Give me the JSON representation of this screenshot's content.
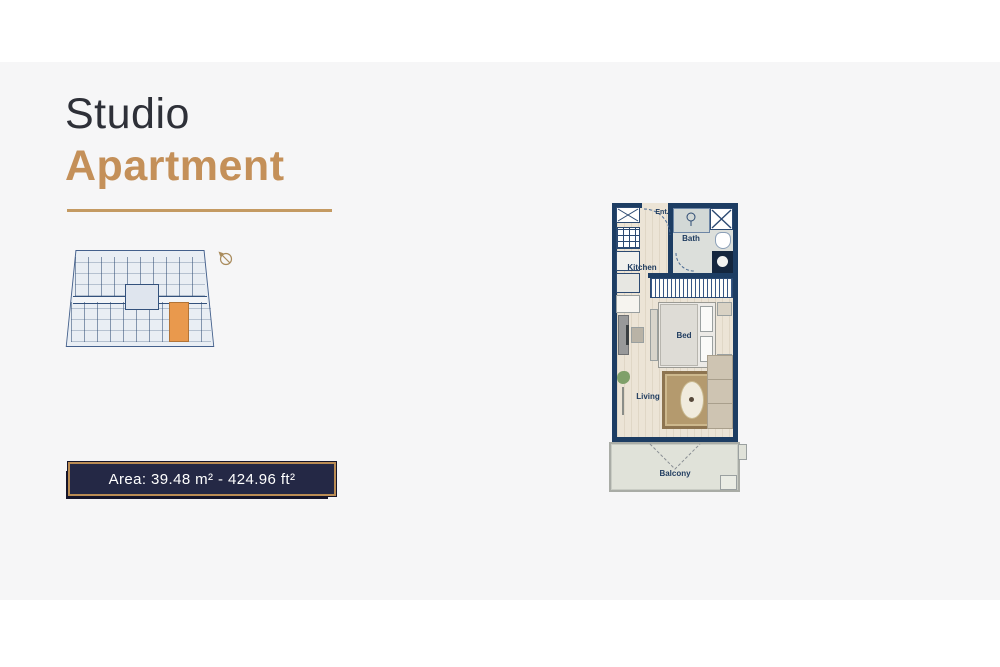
{
  "page": {
    "background": "#ffffff",
    "band_color": "#f6f6f7"
  },
  "header": {
    "title_line1": "Studio",
    "title_line2": "Apartment",
    "title_color": "#2e3038",
    "accent_color": "#c49059",
    "underline_color": "#c49a62"
  },
  "area_badge": {
    "label": "Area: 39.48 m² - 424.96 ft²",
    "background": "#242845",
    "border_color": "#ba8c54",
    "text_color": "#ffffff"
  },
  "key_plan": {
    "description": "building floor plate with current unit highlighted",
    "highlight_color": "#e9994d",
    "background": "#e9eef4",
    "line_color": "#33517c"
  },
  "floor_plan": {
    "wall_color": "#1d3d63",
    "floor_color": "#ece4d6",
    "balcony_floor_color": "#e0e2d9",
    "labels": {
      "entrance": "Ent.",
      "bath": "Bath",
      "kitchen": "Kitchen",
      "bed": "Bed",
      "living": "Living",
      "balcony": "Balcony"
    }
  },
  "icons": {
    "compass": "compass-north-arrow-icon",
    "washer": "washer-x-box-icon",
    "stove": "stove-burner-grid-icon",
    "shower": "shower-head-icon",
    "shaft": "shaft-x-box-icon",
    "toilet": "toilet-icon",
    "sink": "round-sink-icon",
    "plant": "plant-icon",
    "lamp": "floor-lamp-icon"
  }
}
